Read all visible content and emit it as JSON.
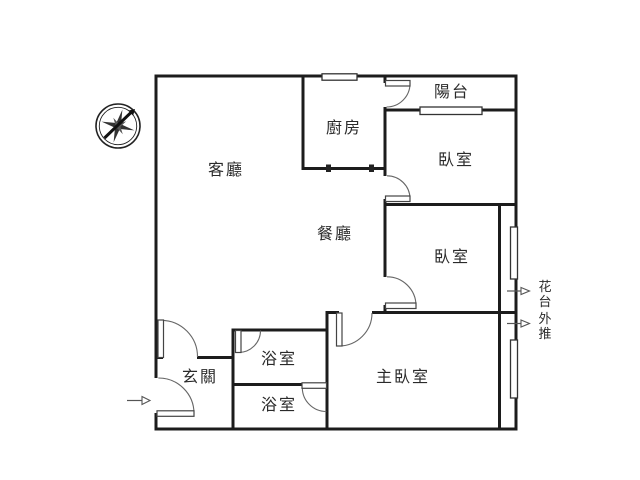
{
  "canvas": {
    "background": "#ffffff",
    "line_color": "#1c1c1c"
  },
  "rooms": [
    {
      "id": "living",
      "label": "客廳"
    },
    {
      "id": "dining",
      "label": "餐廳"
    },
    {
      "id": "kitchen",
      "label": "廚房"
    },
    {
      "id": "balcony",
      "label": "陽台"
    },
    {
      "id": "bedroom-top",
      "label": "臥室"
    },
    {
      "id": "bedroom-mid",
      "label": "臥室"
    },
    {
      "id": "master-bedroom",
      "label": "主臥室"
    },
    {
      "id": "bath-upper",
      "label": "浴室"
    },
    {
      "id": "bath-lower",
      "label": "浴室"
    },
    {
      "id": "entry",
      "label": "玄關"
    }
  ],
  "annotations": {
    "flower_pushout": {
      "text": "花台外推",
      "chars": [
        "花",
        "台",
        "外",
        "推"
      ]
    }
  },
  "icons": {
    "compass": "compass-rose-icon",
    "entry_arrow": "right-arrow-icon",
    "pushout_arrow_1": "right-arrow-icon",
    "pushout_arrow_2": "right-arrow-icon"
  }
}
